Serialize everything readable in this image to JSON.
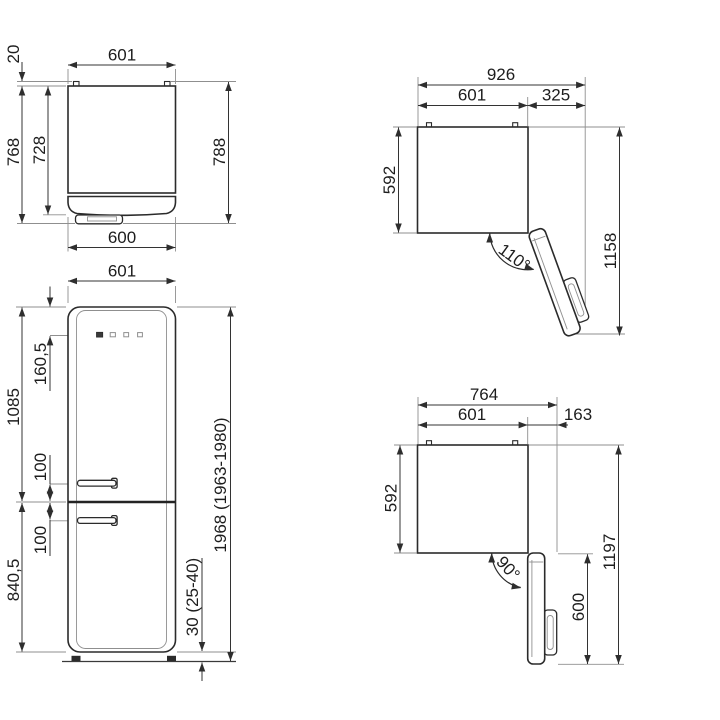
{
  "figure": {
    "type": "appliance-dimension-drawing",
    "background": "#ffffff",
    "line_color": "#2b2b2b"
  },
  "views": {
    "top_closed": {
      "width": "601",
      "back_gap": "20",
      "depth_with_handle": "768",
      "depth_body": "728",
      "depth_overall": "788",
      "door_width": "600"
    },
    "front": {
      "width": "601",
      "controls_offset": "160,5",
      "upper_section": "1085",
      "handle_above": "100",
      "handle_below": "100",
      "lower_section": "840,5",
      "total_height": "1968 (1963-1980)",
      "plinth": "30 (25-40)"
    },
    "open110": {
      "overall_width": "926",
      "body_width": "601",
      "door_extension": "325",
      "depth": "592",
      "overall_depth": "1158",
      "angle": "110°"
    },
    "open90": {
      "overall_width": "764",
      "body_width": "601",
      "door_extension": "163",
      "depth": "592",
      "overall_depth": "1197",
      "door_depth": "600",
      "angle": "90°"
    }
  }
}
